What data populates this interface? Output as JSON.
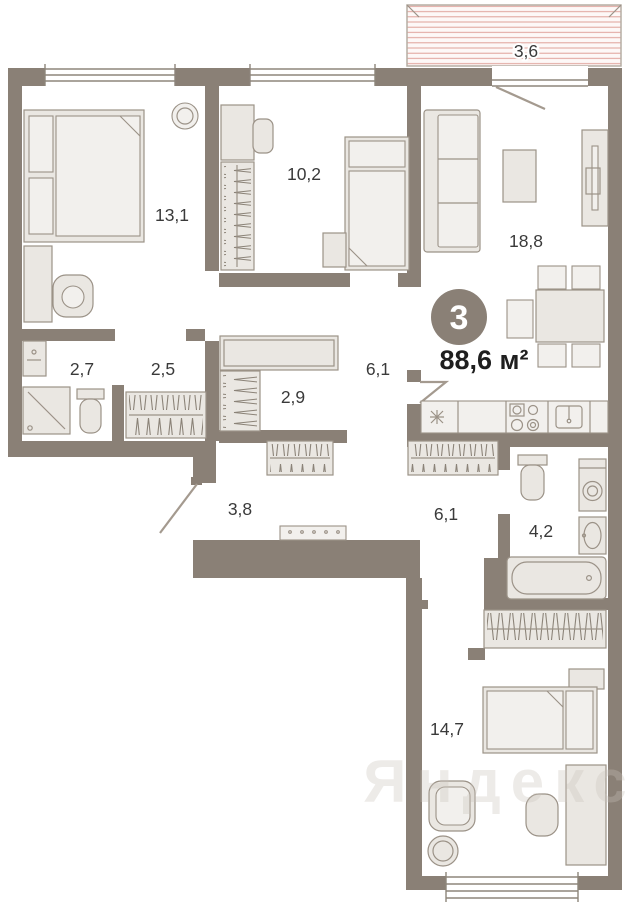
{
  "plan": {
    "badge_rooms": "3",
    "total_area": "88,6 м²",
    "watermark": "Яндекс",
    "rooms": {
      "balcony": "3,6",
      "bedroom_13": "13,1",
      "bedroom_10": "10,2",
      "living_18": "18,8",
      "bath_27": "2,7",
      "hall_25": "2,5",
      "wardrobe_29": "2,9",
      "hall_61_upper": "6,1",
      "hall_38": "3,8",
      "hall_61_lower": "6,1",
      "bath_42": "4,2",
      "bedroom_14": "14,7"
    }
  },
  "colors": {
    "wall": "#8a8076",
    "furn_fill": "#eae7e2",
    "furn_light": "#f2f0ed",
    "furn_stroke": "#9b9287",
    "win_line": "#8d857b",
    "door_line": "#a49a8f",
    "stripe": "#dfa29a",
    "stripe_bg": "#fdf8f7",
    "label": "#3a3a3a",
    "badge_bg": "#8a8076",
    "badge_fg": "#ffffff",
    "watermark": "#c9c2ba"
  }
}
